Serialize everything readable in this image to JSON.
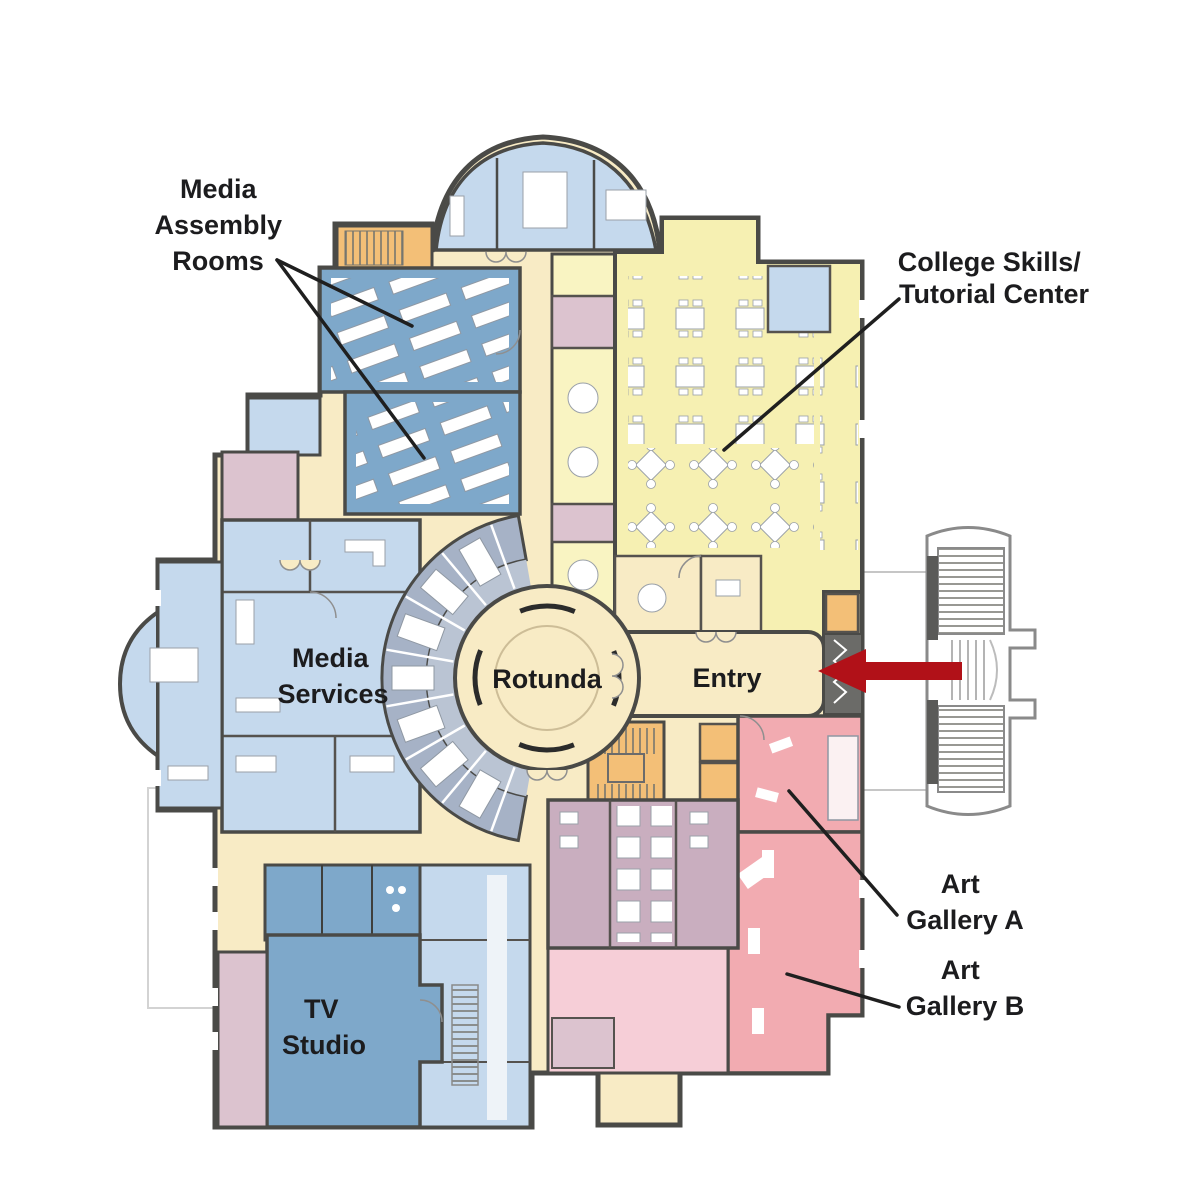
{
  "labels": {
    "media_assembly": {
      "line1": "Media",
      "line2": "Assembly",
      "line3": "Rooms"
    },
    "college_skills": {
      "line1": "College Skills/",
      "line2": "Tutorial Center"
    },
    "media_services": {
      "line1": "Media",
      "line2": "Services"
    },
    "rotunda": "Rotunda",
    "entry": "Entry",
    "art_gallery_a": {
      "line1": "Art",
      "line2": "Gallery A"
    },
    "art_gallery_b": {
      "line1": "Art",
      "line2": "Gallery B"
    },
    "tv_studio": {
      "line1": "TV",
      "line2": "Studio"
    }
  },
  "colors": {
    "wall": "#4a4a47",
    "corridor_cream": "#f8ebc5",
    "room_yellow": "#f6f0b2",
    "room_pale_yellow": "#f9f4c2",
    "room_steel_blue": "#7ea8ca",
    "room_light_blue": "#c5d9ed",
    "room_gray_blue": "#a6b2c6",
    "room_gray_blue_light": "#bac4d3",
    "room_orange": "#f3bf77",
    "room_pink": "#f2abb1",
    "room_pink_light": "#f6ced7",
    "room_mauve": "#c9aebf",
    "room_mauve_light": "#dcc3cf",
    "vestibule_gray": "#6b6b68",
    "arrow_red": "#b11118",
    "leader_line": "#1f1f1f",
    "label_text": "#1c1c1e"
  },
  "arrow": {
    "direction": "left",
    "target": "Entry"
  }
}
